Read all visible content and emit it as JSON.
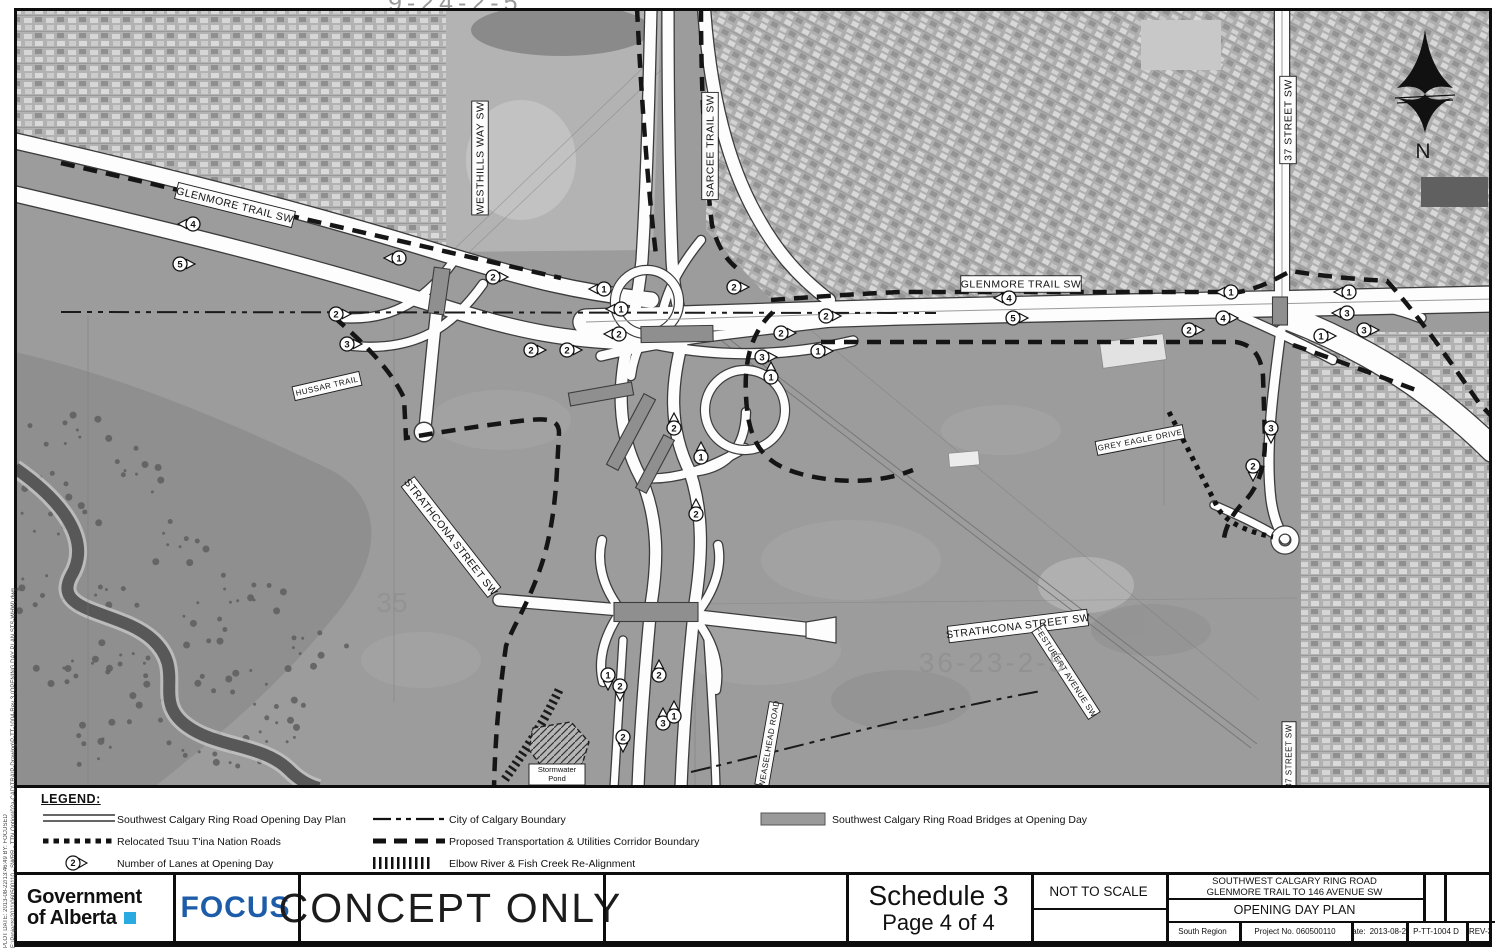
{
  "sheet_top_label": "9-24-2-5",
  "edge_text": {
    "line1": "PLOT DATE: 2013-08-22/13:46:49      BY: FOCUSED",
    "line2": "E:\\Projects\\2011\\060500110 - SWRR - TTN Option\\02a-CAD\\TRA\\P-Drawing\\P-TT-1004-Rev 3 (OPENING DAY PLAN STS-WHW).dwg"
  },
  "map": {
    "north_label": "N",
    "faint_labels": {
      "grid_se": "36-23-2-5",
      "grid_w": "35"
    },
    "stormwater": {
      "lines": [
        "Stormwater",
        "Pond"
      ],
      "x": 556,
      "y": 766
    },
    "road_labels": [
      {
        "text": "GLENMORE TRAIL SW",
        "x": 234,
        "y": 205,
        "rot": 14,
        "fs": 10.5
      },
      {
        "text": "WESTHILLS WAY SW",
        "x": 479,
        "y": 158,
        "rot": -90,
        "fs": 10.5
      },
      {
        "text": "SARCEE TRAIL SW",
        "x": 709,
        "y": 146,
        "rot": -90,
        "fs": 10.5
      },
      {
        "text": "37 STREET SW",
        "x": 1287,
        "y": 120,
        "rot": -90,
        "fs": 10.5
      },
      {
        "text": "GLENMORE TRAIL SW",
        "x": 1020,
        "y": 284,
        "rot": 0,
        "fs": 10.5
      },
      {
        "text": "HUSSAR TRAIL",
        "x": 326,
        "y": 386,
        "rot": -13,
        "fs": 8
      },
      {
        "text": "STRATHCONA STREET SW",
        "x": 450,
        "y": 537,
        "rot": 52,
        "fs": 10.5
      },
      {
        "text": "STRATHCONA STREET SW",
        "x": 1017,
        "y": 626,
        "rot": -7,
        "fs": 10.5
      },
      {
        "text": "FESTUBERT AVENUE SW",
        "x": 1065,
        "y": 672,
        "rot": 57,
        "fs": 8
      },
      {
        "text": "GREY EAGLE DRIVE",
        "x": 1139,
        "y": 440,
        "rot": -11,
        "fs": 8
      },
      {
        "text": "37 STREET SW",
        "x": 1288,
        "y": 756,
        "rot": -90,
        "fs": 8
      },
      {
        "text": "WEASELHEAD ROAD",
        "x": 768,
        "y": 744,
        "rot": -80,
        "fs": 8
      }
    ],
    "lane_markers": [
      {
        "n": "4",
        "x": 192,
        "y": 224,
        "d": "left"
      },
      {
        "n": "5",
        "x": 179,
        "y": 264,
        "d": "right"
      },
      {
        "n": "2",
        "x": 335,
        "y": 314,
        "d": "right"
      },
      {
        "n": "3",
        "x": 346,
        "y": 344,
        "d": "right"
      },
      {
        "n": "1",
        "x": 398,
        "y": 258,
        "d": "left"
      },
      {
        "n": "2",
        "x": 492,
        "y": 277,
        "d": "right"
      },
      {
        "n": "2",
        "x": 530,
        "y": 350,
        "d": "right"
      },
      {
        "n": "2",
        "x": 566,
        "y": 350,
        "d": "right"
      },
      {
        "n": "1",
        "x": 603,
        "y": 289,
        "d": "left"
      },
      {
        "n": "1",
        "x": 620,
        "y": 309,
        "d": "left"
      },
      {
        "n": "2",
        "x": 618,
        "y": 334,
        "d": "left"
      },
      {
        "n": "2",
        "x": 733,
        "y": 287,
        "d": "right"
      },
      {
        "n": "2",
        "x": 825,
        "y": 316,
        "d": "right"
      },
      {
        "n": "2",
        "x": 780,
        "y": 333,
        "d": "right"
      },
      {
        "n": "1",
        "x": 817,
        "y": 351,
        "d": "right"
      },
      {
        "n": "3",
        "x": 761,
        "y": 357,
        "d": "right"
      },
      {
        "n": "1",
        "x": 770,
        "y": 377,
        "d": "up"
      },
      {
        "n": "2",
        "x": 673,
        "y": 428,
        "d": "up"
      },
      {
        "n": "1",
        "x": 700,
        "y": 457,
        "d": "up"
      },
      {
        "n": "2",
        "x": 695,
        "y": 514,
        "d": "up"
      },
      {
        "n": "4",
        "x": 1008,
        "y": 298,
        "d": "left"
      },
      {
        "n": "5",
        "x": 1012,
        "y": 318,
        "d": "right"
      },
      {
        "n": "2",
        "x": 1188,
        "y": 330,
        "d": "right"
      },
      {
        "n": "4",
        "x": 1222,
        "y": 318,
        "d": "right"
      },
      {
        "n": "1",
        "x": 1230,
        "y": 292,
        "d": "left"
      },
      {
        "n": "1",
        "x": 1348,
        "y": 292,
        "d": "left"
      },
      {
        "n": "3",
        "x": 1346,
        "y": 313,
        "d": "left"
      },
      {
        "n": "3",
        "x": 1363,
        "y": 330,
        "d": "right"
      },
      {
        "n": "1",
        "x": 1320,
        "y": 336,
        "d": "right"
      },
      {
        "n": "3",
        "x": 1270,
        "y": 428,
        "d": "down"
      },
      {
        "n": "2",
        "x": 1252,
        "y": 466,
        "d": "down"
      },
      {
        "n": "1",
        "x": 607,
        "y": 675,
        "d": "down"
      },
      {
        "n": "2",
        "x": 619,
        "y": 686,
        "d": "down"
      },
      {
        "n": "2",
        "x": 658,
        "y": 675,
        "d": "up"
      },
      {
        "n": "3",
        "x": 662,
        "y": 723,
        "d": "up"
      },
      {
        "n": "1",
        "x": 673,
        "y": 716,
        "d": "up"
      },
      {
        "n": "2",
        "x": 622,
        "y": 737,
        "d": "down"
      }
    ]
  },
  "legend": {
    "title": "LEGEND:",
    "columns": [
      {
        "sym_x": 22,
        "text_x": 100,
        "items": [
          {
            "symbol": "double-line",
            "label": "Southwest Calgary Ring Road Opening Day Plan"
          },
          {
            "symbol": "dotted",
            "label": "Relocated Tsuu T'ina Nation Roads"
          },
          {
            "symbol": "lane-marker",
            "label": "Number of Lanes at Opening Day"
          }
        ]
      },
      {
        "sym_x": 352,
        "text_x": 432,
        "items": [
          {
            "symbol": "dash-dot",
            "label": "City of Calgary Boundary"
          },
          {
            "symbol": "dashed",
            "label": "Proposed Transportation & Utilities Corridor Boundary"
          },
          {
            "symbol": "rail-hatch",
            "label": "Elbow River & Fish Creek Re-Alignment"
          }
        ]
      },
      {
        "sym_x": 740,
        "text_x": 815,
        "items": [
          {
            "symbol": "bridge-swatch",
            "label": "Southwest Calgary Ring Road Bridges at Opening Day"
          }
        ]
      }
    ]
  },
  "titleblock": {
    "gov": {
      "line1": "Government",
      "line2": "of Alberta"
    },
    "focus": "FOCUS",
    "concept": "CONCEPT ONLY",
    "schedule_line1": "Schedule 3",
    "schedule_line2": "Page 4 of 4",
    "scale_note": "NOT TO SCALE",
    "project_title_1": "SOUTHWEST CALGARY RING ROAD",
    "project_title_2": "GLENMORE TRAIL TO 146 AVENUE SW",
    "project_title_3": "OPENING DAY PLAN",
    "region": "South Region",
    "project_no": "Project No. 060500110",
    "date_label": "Date:",
    "date": "2013-08-22",
    "drawing_no": "P-TT-1004 D",
    "rev": "REV-3"
  }
}
